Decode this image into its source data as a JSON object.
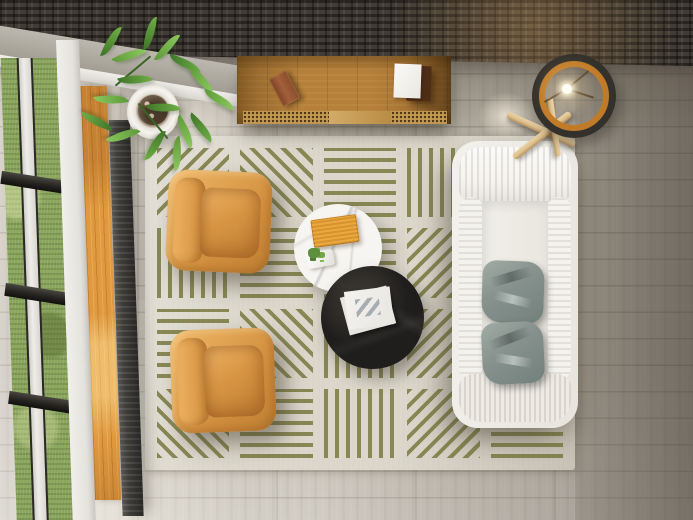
{
  "scene": {
    "description": "Top-down 3D render of a modern living room: white sofa with two gray pillows, two cognac leather armchairs, round white marble and round black coffee tables on a cream rug with olive-green line-block pattern, wooden sideboard against a dark stone wall, tripod ring lamp, potted plant, and a window wall with grass view on gray wood flooring.",
    "view": "bird's-eye / top-down",
    "room": "living room"
  },
  "objects": {
    "wall": "dark stacked-stone accent wall",
    "beam": "concrete corner beam",
    "window": "window wall with grass view",
    "radiator": "floor vent radiator strip",
    "plant": "potted green plant in white pot",
    "sideboard": "wooden sideboard with cane doors",
    "book_brown": "small brown book on sideboard",
    "paper_white": "white booklet on dark book",
    "rug": "cream rug with olive striped blocks",
    "armchair_top": "cognac leather armchair (upper)",
    "armchair_bottom": "cognac leather armchair (lower)",
    "table_white": "round white marble coffee table",
    "tray": "orange tray on marble table",
    "mini_plant": "small plant on white dish",
    "table_black": "round black coffee table",
    "magazine": "white magazine on black table",
    "sofa": "white fabric sofa",
    "pillow_1": "gray cushion (upper)",
    "pillow_2": "gray cushion (lower)",
    "lamp": "tripod ring floor lamp with lit bulb",
    "floor": "gray wood plank flooring"
  },
  "colors": {
    "wall_dark": "#413c35",
    "beam": "#b2aea5",
    "floor_mid": "#c6c0b5",
    "floor_dark": "#857d71",
    "grass": "#8aa55c",
    "frame_dark": "#2b2926",
    "frame_white": "#eae8e4",
    "wood_sill": "#e0993f",
    "radiator": "#3e3c39",
    "rug_base": "#dad6ca",
    "rug_stripe": "#7c7d45",
    "chair": "#dda04e",
    "chair_dark": "#bd8034",
    "sofa": "#f3f1ec",
    "pillow": "#87928e",
    "table_black": "#201e1d",
    "table_white": "#f7f5f1",
    "tray_orange": "#eaa83e",
    "sideboard_wood": "#b5803a",
    "lamp_ring_dark": "#34312c",
    "lamp_ring_orange": "#c17b28",
    "lamp_wood": "#dcc190",
    "leaf_green": "#6fae46"
  },
  "rug": {
    "rows": 4,
    "cols": 5,
    "stripe_width_px": 4,
    "stripe_gap_px": 7,
    "tile_angles": [
      [
        135,
        45,
        0,
        90,
        0
      ],
      [
        90,
        0,
        0,
        135,
        90
      ],
      [
        0,
        45,
        90,
        135,
        0
      ],
      [
        45,
        0,
        90,
        135,
        0
      ]
    ]
  }
}
